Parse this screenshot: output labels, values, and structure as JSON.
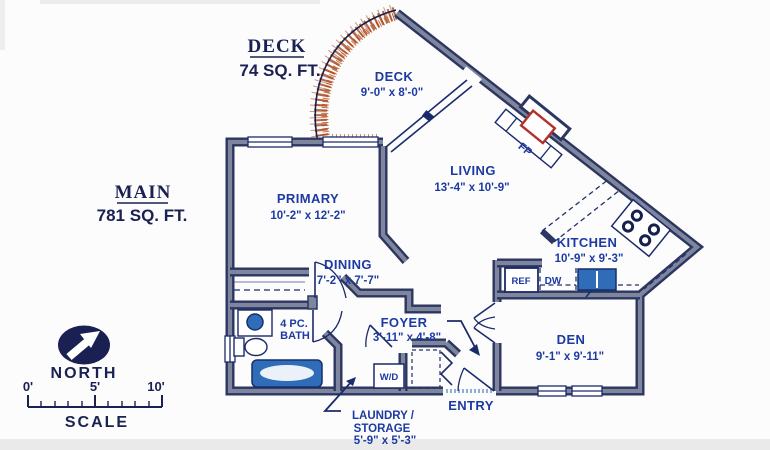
{
  "headers": {
    "deck": {
      "title": "DECK",
      "area": "74 SQ. FT."
    },
    "main": {
      "title": "MAIN",
      "area": "781 SQ. FT."
    }
  },
  "rooms": {
    "deck": {
      "name": "DECK",
      "dims": "9'-0\" x 8'-0\""
    },
    "primary": {
      "name": "PRIMARY",
      "dims": "10'-2\" x 12'-2\""
    },
    "living": {
      "name": "LIVING",
      "dims": "13'-4\" x 10'-9\""
    },
    "dining": {
      "name": "DINING",
      "dims": "7'-2\" x 7'-7\""
    },
    "kitchen": {
      "name": "KITCHEN",
      "dims": "10'-9\" x 9'-3\""
    },
    "foyer": {
      "name": "FOYER",
      "dims": "3'-11\" x 4'-8\""
    },
    "den": {
      "name": "DEN",
      "dims": "9'-1\" x 9'-11\""
    },
    "bath": {
      "line1": "4 PC.",
      "line2": "BATH"
    },
    "laundry": {
      "line1": "LAUNDRY /",
      "line2": "STORAGE",
      "dims": "5'-9\" x 5'-3\""
    }
  },
  "fixtures": {
    "fireplace": "FP",
    "washer_dryer": "W/D",
    "refrigerator": "REF",
    "dishwasher": "DW",
    "entry": "ENTRY"
  },
  "compass": {
    "label": "NORTH"
  },
  "scale_bar": {
    "label": "SCALE",
    "tick_labels": [
      "0'",
      "5'",
      "10'"
    ]
  },
  "colors": {
    "label_blue": "#1d3aa3",
    "header_navy": "#1a2152",
    "wall_edge": "#2c3660",
    "wall_core": "#7e869e",
    "deck_rust": "#a64316",
    "fixture_blue": "#2f6db8",
    "fireplace_red": "#b23228",
    "background": "#fcfcfd"
  }
}
